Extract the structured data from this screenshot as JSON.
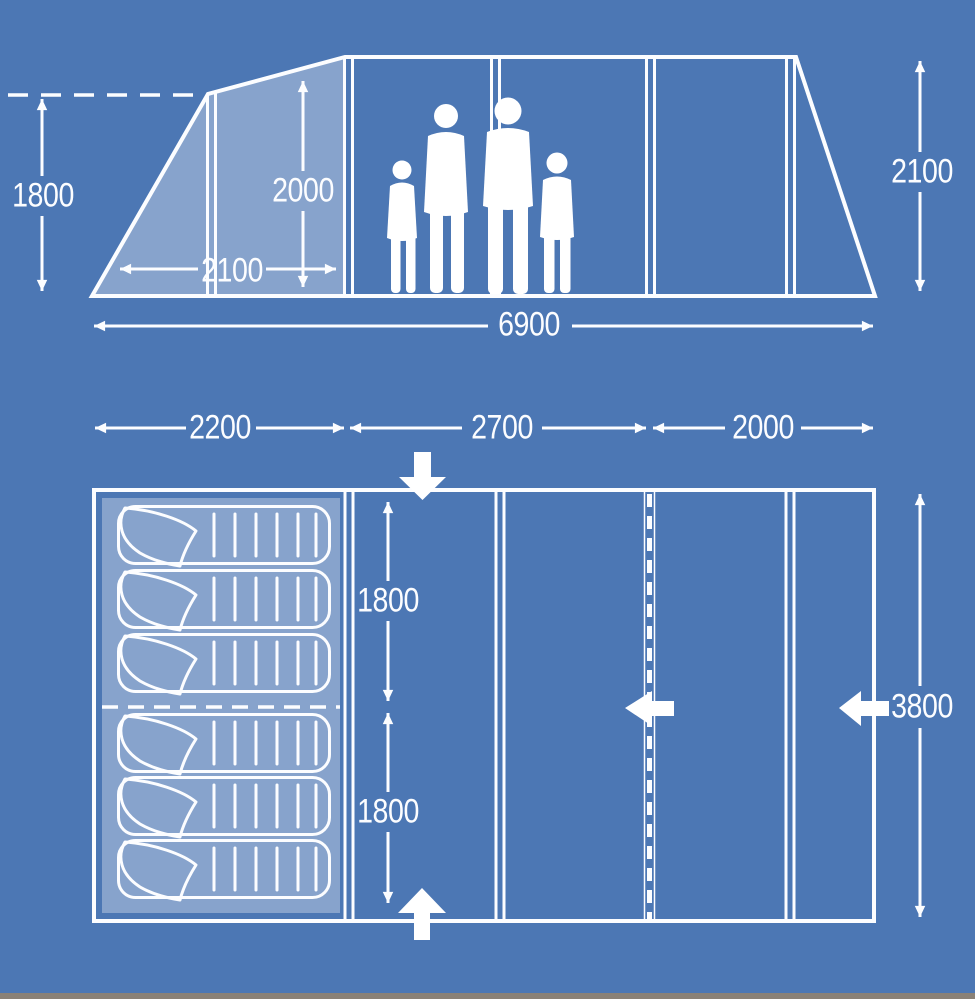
{
  "diagram_title": "Tent dimensions blueprint diagram",
  "colors": {
    "background": "#4C77B4",
    "line": "#FCFDFF",
    "panel_fill": "rgba(255,255,255,0.33)",
    "bottom_edge_strip": "#8a8177"
  },
  "side_view": {
    "description": "side elevation of tunnel tent with family silhouette",
    "dims": {
      "front_wall_height": "1800",
      "interior_height": "2000",
      "porch_depth": "2100",
      "overall_length": "6900",
      "max_height": "2100"
    }
  },
  "floor_plan": {
    "description": "top-down floor plan with six sleeping bags and entrance arrows",
    "dims": {
      "bedroom_length": "2200",
      "living_length": "2700",
      "front_length": "2000",
      "bedroom_depth_front": "1800",
      "bedroom_depth_rear": "1800",
      "overall_width": "3800"
    },
    "sleeping_bag_count": 6,
    "icons": {
      "top_entrance": "block-arrow-down",
      "bottom_entrance": "block-arrow-up",
      "inner_door": "block-arrow-left",
      "side_door": "block-arrow-left"
    }
  }
}
